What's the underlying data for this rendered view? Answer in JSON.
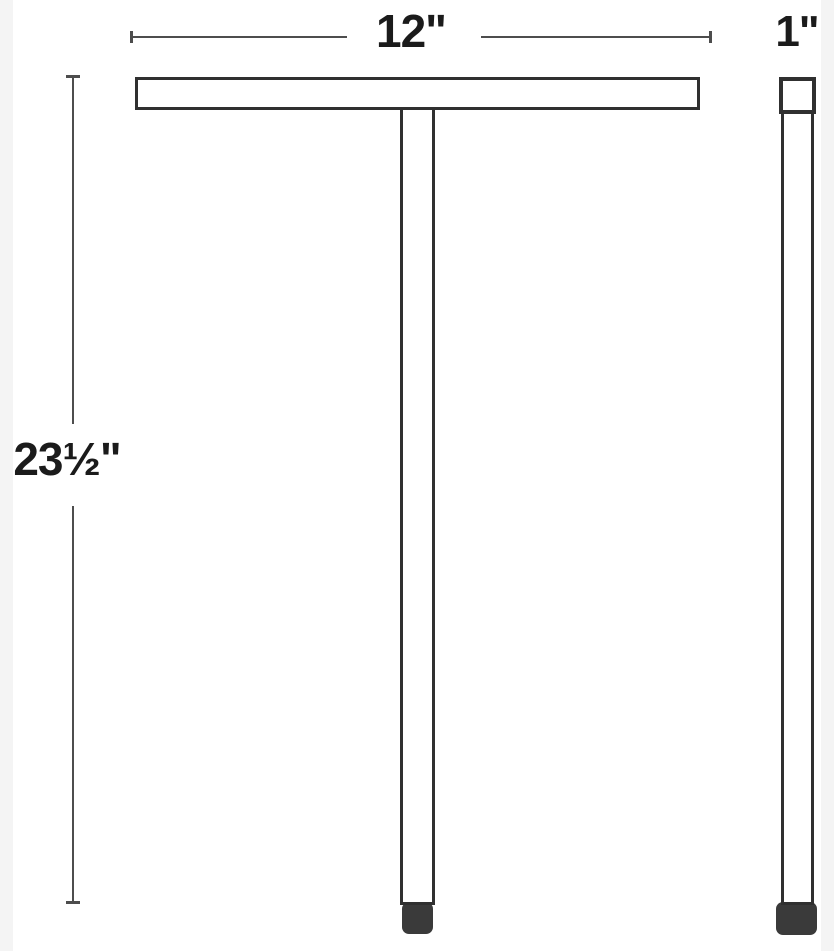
{
  "title": "Fixture dimension diagram",
  "diagram": {
    "dimensions": {
      "width": {
        "label": "12\""
      },
      "depth": {
        "label": "1\""
      },
      "height": {
        "label": "23½\""
      }
    },
    "colors": {
      "bg": "#ffffff",
      "band": "#f4f4f4",
      "outline": "#303030",
      "dimline": "#4d4d4d",
      "text": "#1b1b1b",
      "cap": "#3a3a3a"
    }
  }
}
